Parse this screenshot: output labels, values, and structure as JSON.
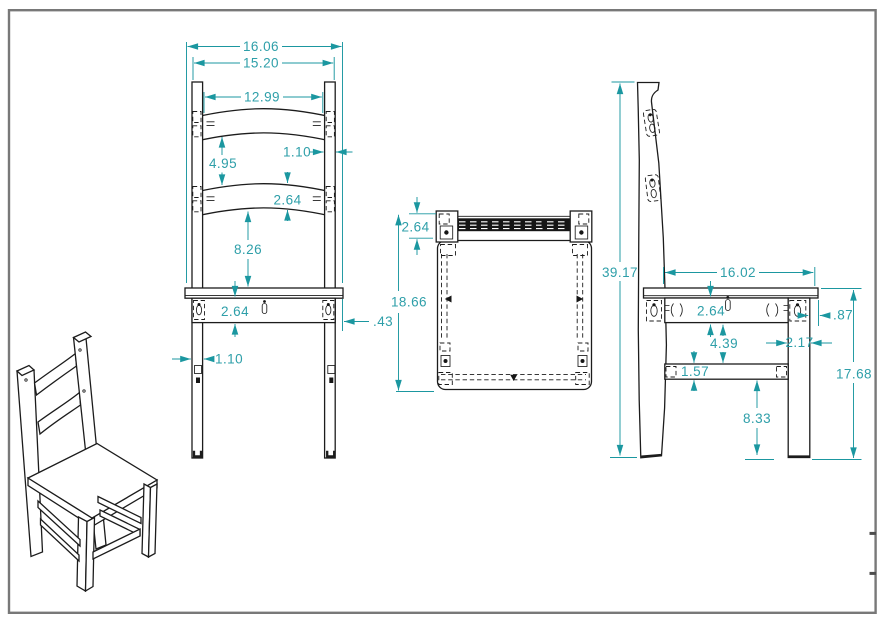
{
  "drawing": {
    "type": "technical-drawing",
    "subject": "wooden ladder-back side chair, orthographic views with isometric projection",
    "colors": {
      "dimension_line": "#1b97a0",
      "dimension_text": "#2e9fa9",
      "object_line": "#1c1c1c",
      "border": "#787878",
      "background": "#ffffff"
    },
    "views": {
      "isometric": {
        "label": "isometric view"
      },
      "front": {
        "label": "front view",
        "dims": {
          "overall_width": "16.06",
          "outside_posts_width": "15.20",
          "slat_width": "12.99",
          "slat_spacing": "4.95",
          "post_width": "1.10",
          "slat_thickness": "2.64",
          "slat_to_seat": "8.26",
          "apron_height": "2.64",
          "seat_overhang": ".43",
          "leg_width": "1.10"
        }
      },
      "top": {
        "label": "top view",
        "dims": {
          "back_depth": "2.64",
          "overall_depth": "18.66"
        }
      },
      "side": {
        "label": "side view",
        "dims": {
          "overall_height": "39.17",
          "seat_depth": "16.02",
          "apron_height": "2.64",
          "seat_front_overhang": ".87",
          "apron_to_stretcher": "4.39",
          "leg_depth": "2.17",
          "stretcher_height": "1.57",
          "stretcher_to_floor": "8.33",
          "seat_height": "17.68"
        }
      }
    }
  }
}
